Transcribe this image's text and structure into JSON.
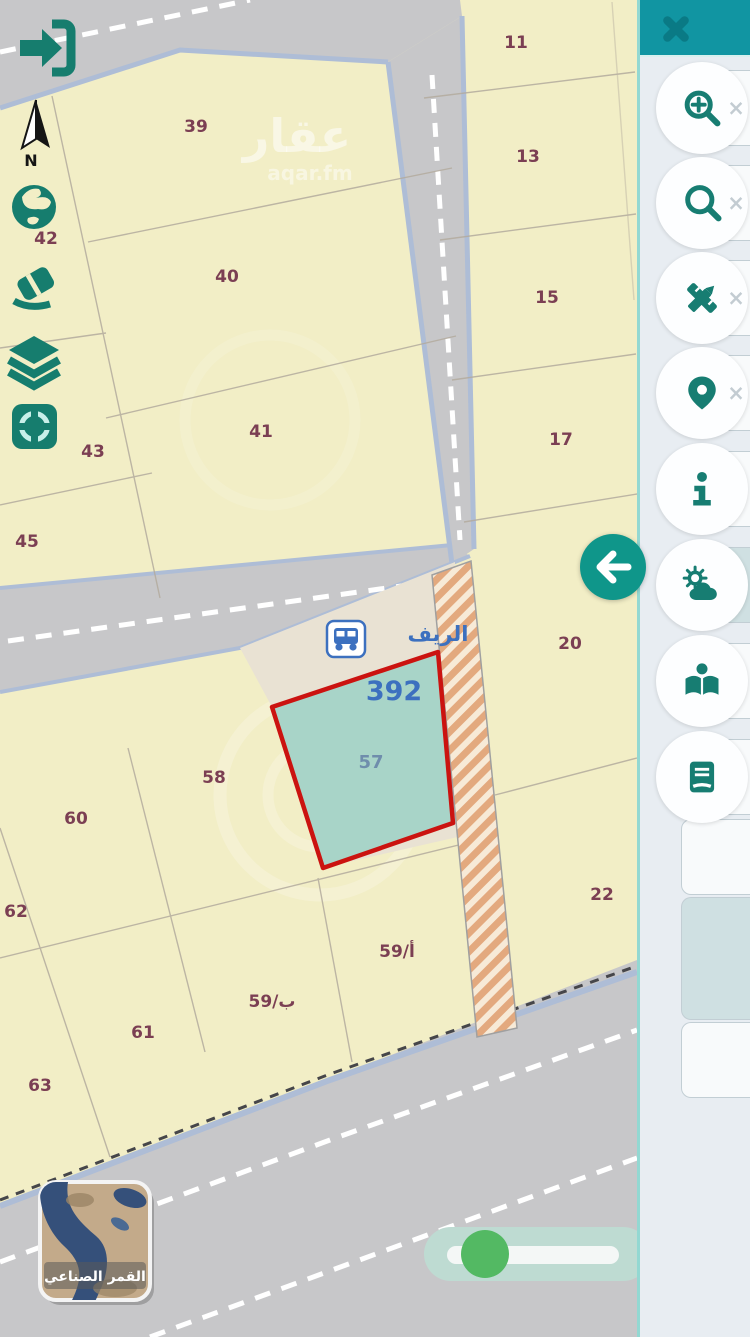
{
  "app": {
    "watermark": {
      "title": "عقار",
      "subtitle": "aqar.fm"
    },
    "colors": {
      "accent_teal": "#1195a2",
      "icon_teal": "#167d6e",
      "highlight_red": "#cb1310",
      "highlight_fill": "#a8d4c8",
      "label_blue": "#3c70bf",
      "parcel_text": "#7b3f53",
      "road_gray": "#c7c7c9",
      "parcel_yellow": "#f2eec6",
      "slider_green": "#53b963"
    }
  },
  "map": {
    "north_label": "N",
    "street_label": "الريف",
    "highlight": {
      "block_number": "392",
      "parcel_number": "57"
    },
    "parcel_labels": [
      "11",
      "13",
      "15",
      "17",
      "20",
      "22",
      "39",
      "40",
      "41",
      "42",
      "43",
      "45",
      "58",
      "59/أ",
      "59/ب",
      "60",
      "61",
      "62",
      "63"
    ],
    "satellite_button_label": "القمر الصناعي",
    "tools": [
      {
        "icon": "login-arrow-icon"
      },
      {
        "icon": "north-compass-icon"
      },
      {
        "icon": "globe-icon"
      },
      {
        "icon": "eraser-icon"
      },
      {
        "icon": "layers-icon"
      },
      {
        "icon": "locate-crosshair-icon"
      }
    ]
  },
  "sidebar": {
    "close_icon": "close-icon",
    "back_icon": "back-arrow-icon",
    "buttons": [
      {
        "icon": "zoom-in-icon",
        "dismiss": "×"
      },
      {
        "icon": "search-icon",
        "dismiss": "×"
      },
      {
        "icon": "drawing-tools-icon",
        "dismiss": "×"
      },
      {
        "icon": "location-pin-icon",
        "dismiss": "×"
      },
      {
        "icon": "info-icon"
      },
      {
        "icon": "weather-icon"
      },
      {
        "icon": "open-book-icon"
      },
      {
        "icon": "notebook-icon"
      }
    ]
  }
}
